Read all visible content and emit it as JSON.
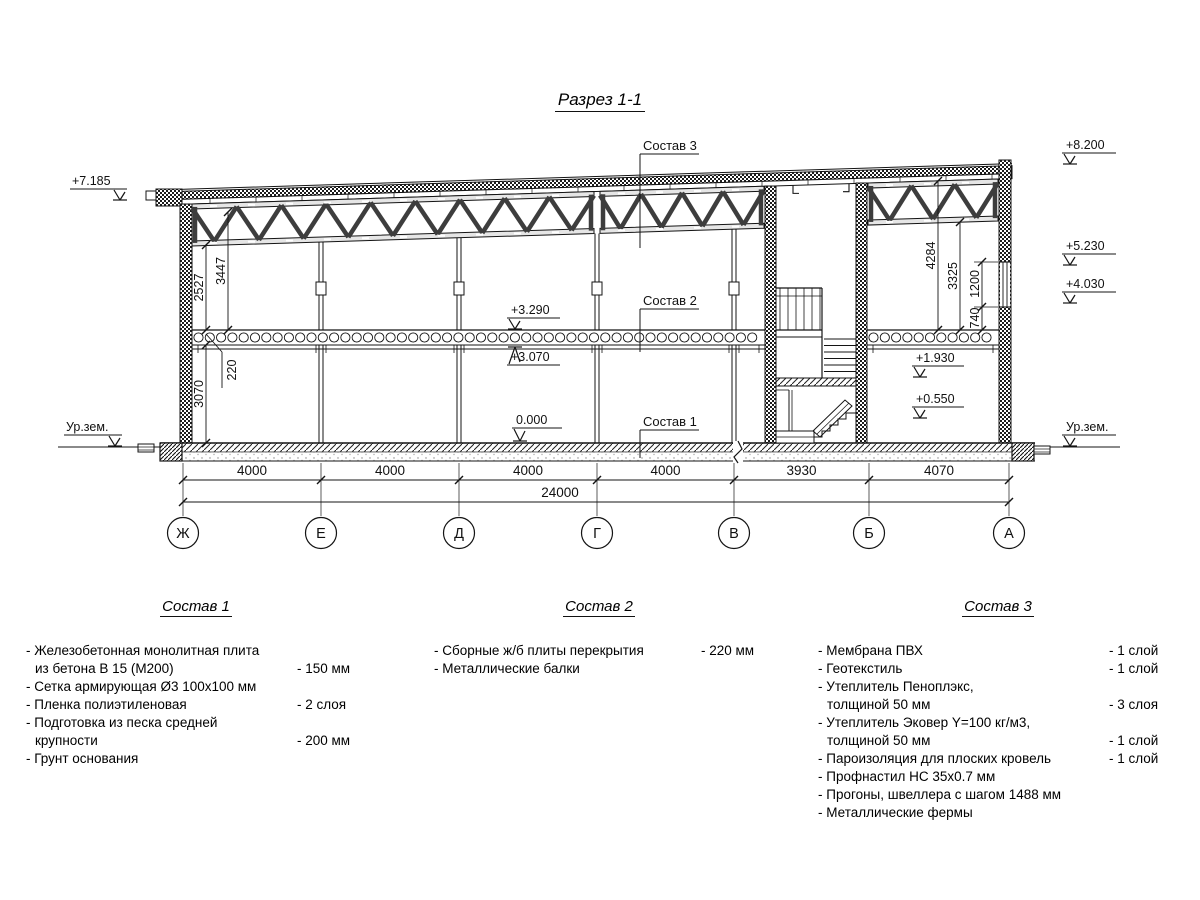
{
  "title": "Разрез 1-1",
  "drawing": {
    "levels": {
      "e7185": "+7.185",
      "e8200": "+8.200",
      "e5230": "+5.230",
      "e4030": "+4.030",
      "e3290": "+3.290",
      "e3070": "+3.070",
      "e0": "0.000",
      "e1930": "+1.930",
      "e0550": "+0.550",
      "ur_l": "Ур.зем.",
      "ur_r": "Ур.зем."
    },
    "vdims": {
      "v2527": "2527",
      "v3447": "3447",
      "v220": "220",
      "v3070": "3070",
      "v4284": "4284",
      "v3325": "3325",
      "v1200": "1200",
      "v740": "740"
    },
    "spans": [
      "4000",
      "4000",
      "4000",
      "4000",
      "3930",
      "4070"
    ],
    "total": "24000",
    "axes": [
      "Ж",
      "Е",
      "Д",
      "Г",
      "В",
      "Б",
      "А"
    ],
    "callouts": {
      "c1": "Состав 1",
      "c2": "Состав 2",
      "c3": "Состав 3"
    }
  },
  "comp1": {
    "title": "Состав 1",
    "items": [
      {
        "label": "- Железобетонная  монолитная плита\nиз бетона В 15 (М200)",
        "value": "- 150 мм"
      },
      {
        "label": "- Сетка армирующая Ø3 100x100 мм",
        "value": ""
      },
      {
        "label": "- Пленка полиэтиленовая",
        "value": "-  2 слоя"
      },
      {
        "label": "- Подготовка из песка средней\nкрупности",
        "value": "- 200 мм"
      },
      {
        "label": "- Грунт основания",
        "value": ""
      }
    ]
  },
  "comp2": {
    "title": "Состав 2",
    "items": [
      {
        "label": "- Сборные ж/б плиты перекрытия",
        "value": "- 220 мм"
      },
      {
        "label": "- Металлические балки",
        "value": ""
      }
    ]
  },
  "comp3": {
    "title": "Состав 3",
    "items": [
      {
        "label": "- Мембрана ПВХ",
        "value": "- 1 слой"
      },
      {
        "label": "- Геотекстиль",
        "value": "- 1 слой"
      },
      {
        "label": "- Утеплитель Пеноплэкс,\nтолщиной 50 мм",
        "value": "- 3 слоя"
      },
      {
        "label": "- Утеплитель Эковер Y=100 кг/м3,\nтолщиной 50 мм",
        "value": "- 1 слой"
      },
      {
        "label": "- Пароизоляция для плоских кровель",
        "value": "- 1 слой"
      },
      {
        "label": "- Профнастил НС 35x0.7 мм",
        "value": ""
      },
      {
        "label": "- Прогоны, швеллера с шагом 1488 мм",
        "value": ""
      },
      {
        "label": "- Металлические фермы",
        "value": ""
      }
    ]
  }
}
